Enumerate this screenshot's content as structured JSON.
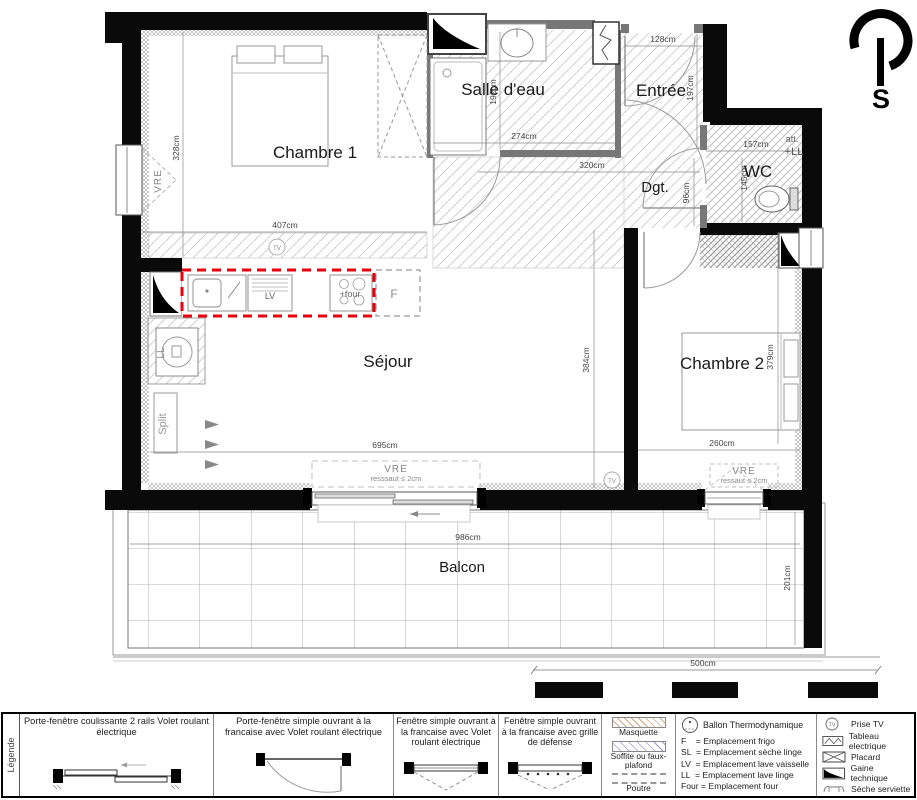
{
  "compass": {
    "south_label": "S"
  },
  "rooms": {
    "chambre1": "Chambre 1",
    "salle_deau": "Salle d'eau",
    "entree": "Entrée",
    "wc": "WC",
    "dgt": "Dgt.",
    "sejour": "Séjour",
    "chambre2": "Chambre 2",
    "balcon": "Balcon"
  },
  "annotations": {
    "att": "att.",
    "plus_ll": "+LL",
    "vre": "VRE",
    "sejour_threshold": "resssaut ≤ 2cm",
    "chambre2_threshold": "ressaut ≤ 2cm",
    "split": "Split",
    "lv": "LV",
    "four": "+four",
    "frigo": "F",
    "lave_linge": "LL",
    "tv": "TV"
  },
  "dimensions": {
    "chambre1_w": "407cm",
    "chambre1_h": "328cm",
    "salle_deau_w": "274cm",
    "salle_deau_h": "192cm",
    "entree_w": "128cm",
    "entree_h": "197cm",
    "dgt_w": "320cm",
    "dgt_h": "96cm",
    "wc_w": "157cm",
    "wc_h": "145cm",
    "sejour_w": "695cm",
    "sejour_h": "384cm",
    "chambre2_w": "260cm",
    "chambre2_h": "379cm",
    "balcon_w": "986cm",
    "balcon_h": "201cm",
    "balcon_seg": "500cm"
  },
  "legend": {
    "title": "Légende",
    "openings": [
      "Porte-fenêtre coulissante 2 rails Volet roulant électrique",
      "Porte-fenêtre simple ouvrant à la francaise avec Volet roulant électrique",
      "Fenêtre simple ouvrant à la francaise avec Volet roulant électrique",
      "Fenêtre simple ouvrant à la francaise avec grille de défense"
    ],
    "surfaces": [
      "Masquette",
      "Soffite ou faux-plafond",
      "Poutre"
    ],
    "ballon": "Ballon Thermodynamique",
    "abbreviations": [
      "F    = Emplacement frigo",
      "SL  = Emplacement sèche linge",
      "LV  = Emplacement lave vaisselle",
      "LL  = Emplacement lave linge",
      "Four = Emplacement four"
    ],
    "symbols": [
      "Prise TV",
      "Tableau electrique",
      "Placard",
      "Gaine technique",
      "Sèche serviette"
    ]
  },
  "colors": {
    "kitchen_outline": "#e8000d",
    "walls": "#000000",
    "masquette_hatch": "#d2a985",
    "soffite_hatch": "#9b9bd0"
  }
}
